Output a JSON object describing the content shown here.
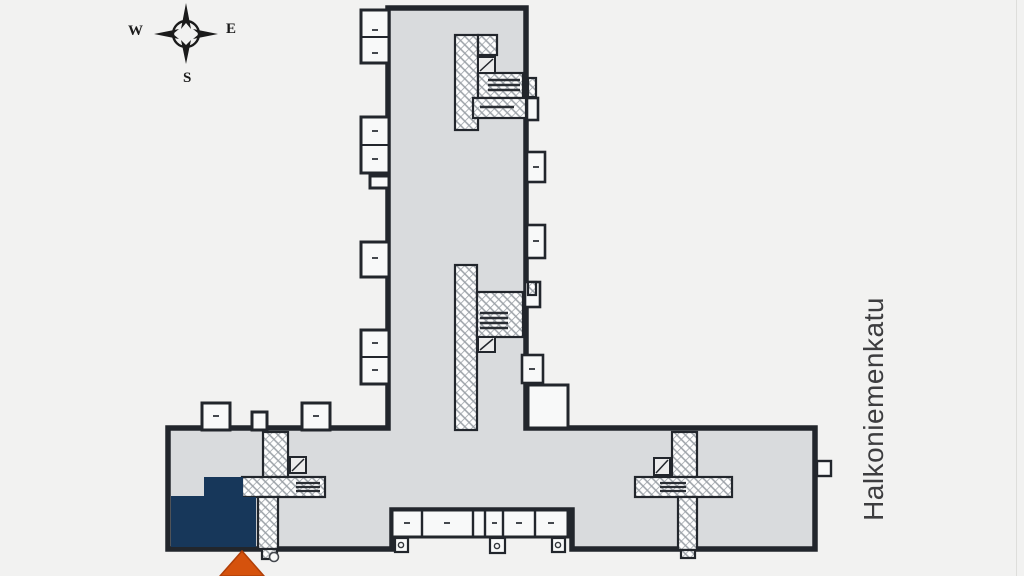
{
  "title": "Building site floor plan",
  "compass": {
    "west": "W",
    "east": "E",
    "south": "S"
  },
  "street": {
    "name": "Halkoniemenkatu"
  },
  "colors": {
    "background": "#f2f2f1",
    "building_fill": "#d9dbdd",
    "wall": "#22262c",
    "balcony_fill": "#f8f9f9",
    "highlight_unit": "#17375a",
    "arrow": "#d5520d",
    "arrow_edge": "#b03f08",
    "hatch_line": "#9aa0a6"
  }
}
